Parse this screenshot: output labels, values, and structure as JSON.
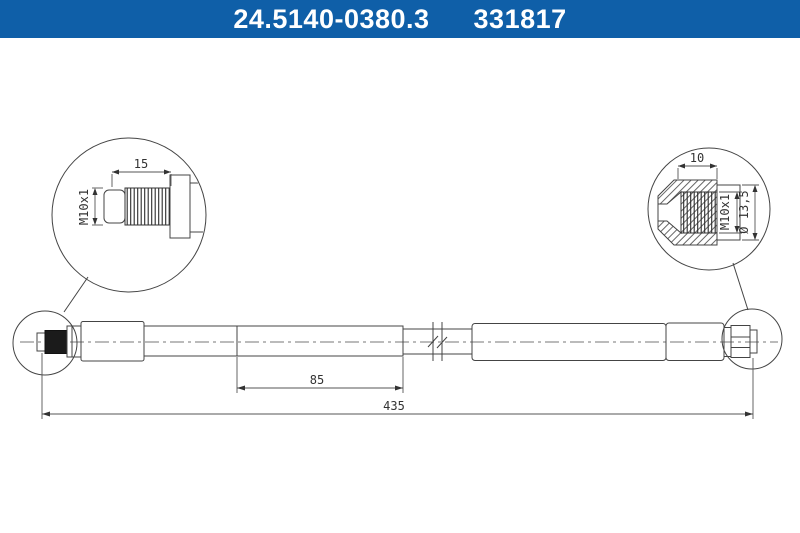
{
  "theme": {
    "header-bg": "#0F5FA8",
    "header-text": "#FFFFFF",
    "line-color": "#444444",
    "page-bg": "#FFFFFF"
  },
  "header": {
    "part_number": "24.5140-0380.3",
    "article_number": "331817"
  },
  "drawing": {
    "left_detail": {
      "thread_length_label": "15",
      "thread_spec_label": "M10x1"
    },
    "right_detail": {
      "thread_length_label": "10",
      "thread_spec_label": "M10x1",
      "diameter_label": "Ø 13,5"
    },
    "main_view": {
      "section_length_label": "85",
      "total_length_label": "435"
    }
  }
}
